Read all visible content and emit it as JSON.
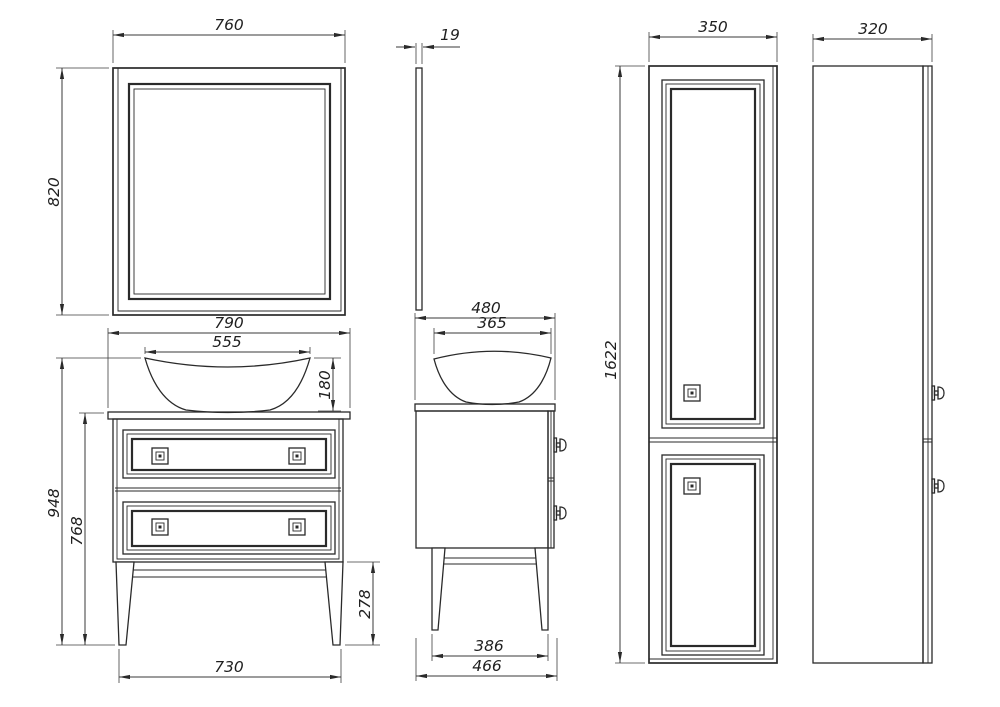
{
  "dimensions": {
    "mirror_front": {
      "width": "760",
      "height": "820"
    },
    "mirror_side": {
      "thickness": "19"
    },
    "vanity_front": {
      "countertop_width": "790",
      "basin_width": "555",
      "basin_height": "180",
      "total_height": "948",
      "height_to_countertop": "768",
      "leg_height": "278",
      "feet_span": "730"
    },
    "vanity_side": {
      "countertop_depth": "480",
      "basin_depth": "365",
      "feet_span": "386",
      "total_depth": "466"
    },
    "tall_cabinet_front": {
      "width": "350",
      "height": "1622"
    },
    "tall_cabinet_side": {
      "depth": "320"
    }
  },
  "colors": {
    "line": "#2a2a2a",
    "background": "#ffffff"
  }
}
